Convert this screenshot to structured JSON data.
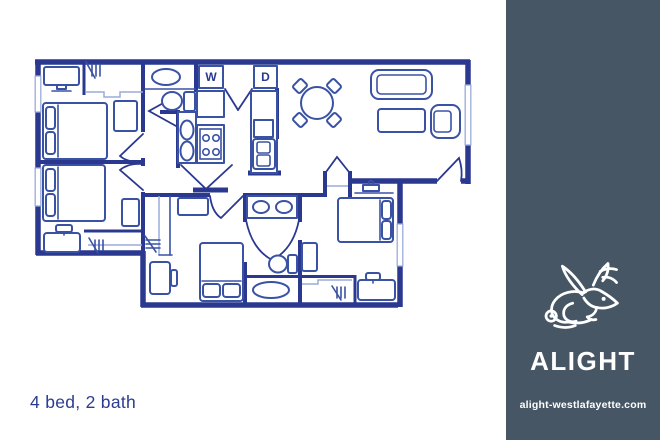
{
  "floorplan": {
    "caption": "4 bed, 2 bath",
    "washer_label": "W",
    "dryer_label": "D",
    "wall_color": "#2a3890",
    "furniture_color": "#3a52a3",
    "window_color": "#9aabdb"
  },
  "sidebar": {
    "background": "#465665",
    "logo": "jackalope-icon",
    "brand": "ALIGHT",
    "website": "alight-westlafayette.com"
  }
}
